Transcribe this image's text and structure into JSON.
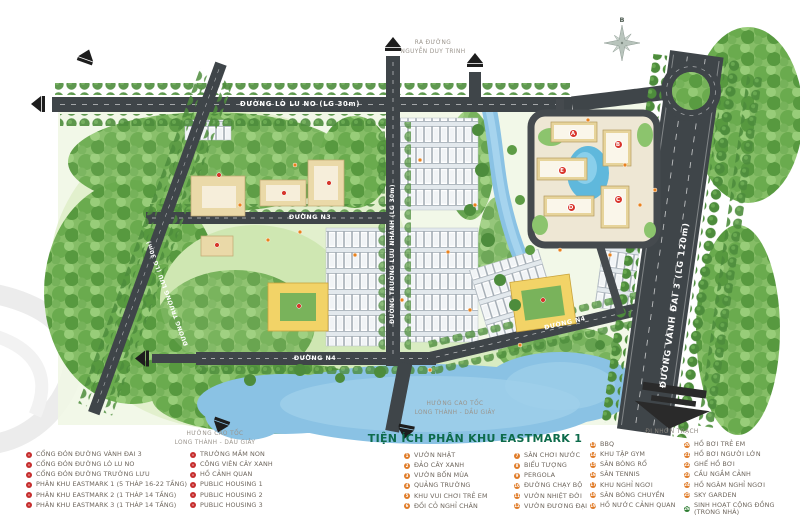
{
  "map": {
    "roads": {
      "lo_lu": "ĐƯỜNG LÒ LU NO (LG 30m)",
      "vanh_dai_3": "ĐƯỜNG VÀNH ĐAI 3 (LG 120m)",
      "truong_luu": "ĐƯỜNG TRƯỜNG LƯU (LG 30m)",
      "truong_luu_nhanh": "ĐƯỜNG TRƯỜNG LƯU NHÁNH (LG 30m)",
      "n3": "ĐƯỜNG N3",
      "n4": "ĐƯỜNG N4",
      "n4b": "ĐƯỜNG N4"
    },
    "directions": {
      "nguyen_duy_trinh_1": "RA ĐƯỜNG",
      "nguyen_duy_trinh_2": "NGUYỄN DUY TRINH",
      "cao_toc_1": "HƯỚNG CAO TỐC",
      "cao_toc_2": "LONG THÀNH - DẦU GIÂY",
      "nhon_trach": "ĐI NHƠN TRẠCH",
      "compass_north": "B"
    },
    "towers": {
      "a": "A",
      "b": "B",
      "c": "C",
      "d": "D",
      "e": "E"
    }
  },
  "legend": {
    "title": "TIỆN ÍCH PHÂN KHU EASTMARK 1",
    "columns": [
      {
        "items": [
          {
            "marker": "red",
            "label": "CỔNG ĐÓN ĐƯỜNG VÀNH ĐAI 3"
          },
          {
            "marker": "red",
            "label": "CỔNG ĐÓN ĐƯỜNG LÒ LU NO"
          },
          {
            "marker": "red",
            "label": "CỔNG ĐÓN ĐƯỜNG TRƯỜNG LƯU"
          },
          {
            "marker": "red",
            "label": "PHÂN KHU EASTMARK 1 (5 THÁP 16-22 TẦNG)"
          },
          {
            "marker": "red",
            "label": "PHÂN KHU EASTMARK 2 (1 THÁP 14 TẦNG)"
          },
          {
            "marker": "red",
            "label": "PHÂN KHU EASTMARK 3 (1 THÁP 14 TẦNG)"
          }
        ]
      },
      {
        "items": [
          {
            "marker": "red",
            "label": "TRƯỜNG MẦM NON"
          },
          {
            "marker": "red",
            "label": "CÔNG VIÊN CÂY XANH"
          },
          {
            "marker": "red",
            "label": "HỒ CẢNH QUAN"
          },
          {
            "marker": "red",
            "label": "PUBLIC HOUSING 1"
          },
          {
            "marker": "red",
            "label": "PUBLIC HOUSING 2"
          },
          {
            "marker": "red",
            "label": "PUBLIC HOUSING 3"
          }
        ]
      },
      {
        "items": [
          {
            "marker": "orange",
            "num": "1",
            "label": "VƯỜN NHẬT"
          },
          {
            "marker": "orange",
            "num": "2",
            "label": "ĐẢO CÂY XANH"
          },
          {
            "marker": "orange",
            "num": "3",
            "label": "VƯỜN BỐN MÙA"
          },
          {
            "marker": "orange",
            "num": "4",
            "label": "QUẢNG TRƯỜNG"
          },
          {
            "marker": "orange",
            "num": "5",
            "label": "KHU VUI CHƠI TRẺ EM"
          },
          {
            "marker": "orange",
            "num": "6",
            "label": "ĐỒI CỎ NGHỈ CHÂN"
          }
        ]
      },
      {
        "items": [
          {
            "marker": "orange",
            "num": "7",
            "label": "SÂN CHƠI NƯỚC"
          },
          {
            "marker": "orange",
            "num": "8",
            "label": "BIỂU TƯỢNG"
          },
          {
            "marker": "orange",
            "num": "9",
            "label": "PERGOLA"
          },
          {
            "marker": "orange",
            "num": "10",
            "label": "ĐƯỜNG CHẠY BỘ"
          },
          {
            "marker": "orange",
            "num": "11",
            "label": "VƯỜN NHIỆT ĐỚI"
          },
          {
            "marker": "orange",
            "num": "12",
            "label": "VƯỜN ĐƯƠNG ĐẠI"
          }
        ]
      },
      {
        "items": [
          {
            "marker": "orange",
            "num": "13",
            "label": "BBQ"
          },
          {
            "marker": "orange",
            "num": "14",
            "label": "KHU TẬP GYM"
          },
          {
            "marker": "orange",
            "num": "15",
            "label": "SÂN BÓNG RỔ"
          },
          {
            "marker": "orange",
            "num": "16",
            "label": "SÂN TENNIS"
          },
          {
            "marker": "orange",
            "num": "17",
            "label": "KHU NGHỈ NGƠI"
          },
          {
            "marker": "orange",
            "num": "18",
            "label": "SÂN BÓNG CHUYỀN"
          },
          {
            "marker": "orange",
            "num": "19",
            "label": "HỒ NƯỚC CẢNH QUAN"
          }
        ]
      },
      {
        "items": [
          {
            "marker": "orange",
            "num": "20",
            "label": "HỒ BƠI TRẺ EM"
          },
          {
            "marker": "orange",
            "num": "21",
            "label": "HỒ BƠI NGƯỜI LỚN"
          },
          {
            "marker": "orange",
            "num": "22",
            "label": "GHẾ HỒ BƠI"
          },
          {
            "marker": "orange",
            "num": "23",
            "label": "CẦU NGẮM CẢNH"
          },
          {
            "marker": "orange",
            "num": "24",
            "label": "HỒ NGÂM NGHỈ NGƠI"
          },
          {
            "marker": "orange",
            "num": "25",
            "label": "SKY GARDEN"
          },
          {
            "marker": "green",
            "num": "26",
            "label": "SINH HOẠT CỘNG ĐỒNG",
            "label2": "(TRONG NHÀ)"
          }
        ]
      }
    ]
  },
  "colors": {
    "accent_green": "#0d6b4b",
    "marker_red": "#c62f2f",
    "marker_orange": "#e07b27",
    "marker_green": "#2e7d32",
    "road": "#3f4549",
    "water": "#8ac2e4"
  }
}
